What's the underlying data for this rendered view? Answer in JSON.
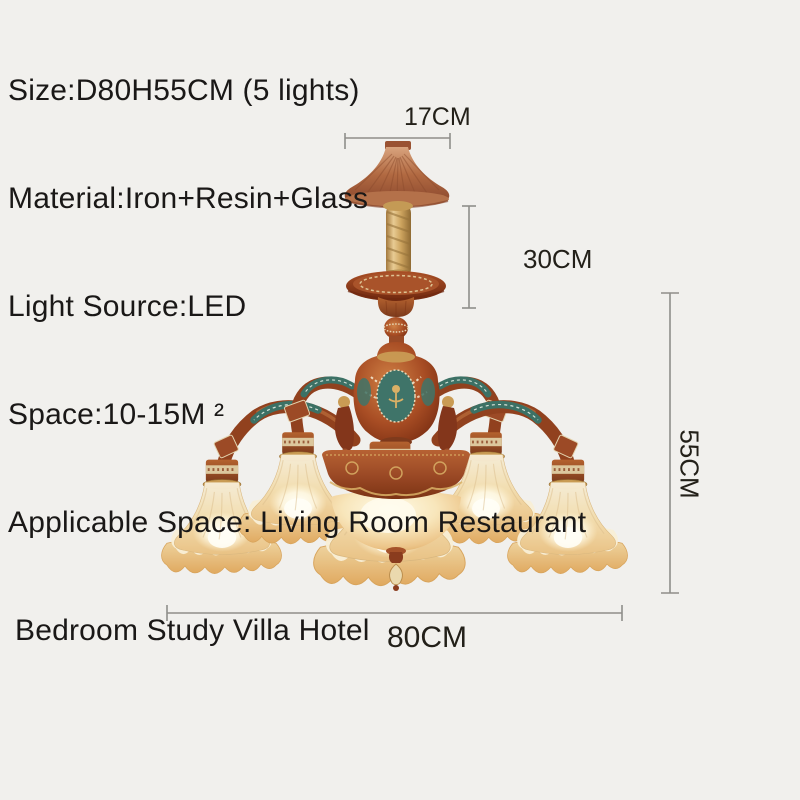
{
  "page": {
    "background_color": "#f1f0ed",
    "description": "Chandelier product dimension image"
  },
  "specs": {
    "lines": [
      "Size:D80H55CM (5 lights)",
      "Material:Iron+Resin+Glass",
      "Light Source:LED",
      "Space:10-15M ²",
      "Applicable Space: Living Room Restaurant",
      "Bedroom Study Villa Hotel"
    ]
  },
  "dimensions": {
    "canopy_width": "17CM",
    "hanging_drop": "30CM",
    "body_height": "55CM",
    "body_diameter": "80CM"
  },
  "product": {
    "lights_count": "5",
    "colors": {
      "body_copper": "#a34a22",
      "enamel_teal": "#3c7165",
      "chain_gold": "#c9a45f",
      "glass_shade": "#f3ddae",
      "text": "#1a1817",
      "dimension_line": "#8f8e8a"
    }
  }
}
